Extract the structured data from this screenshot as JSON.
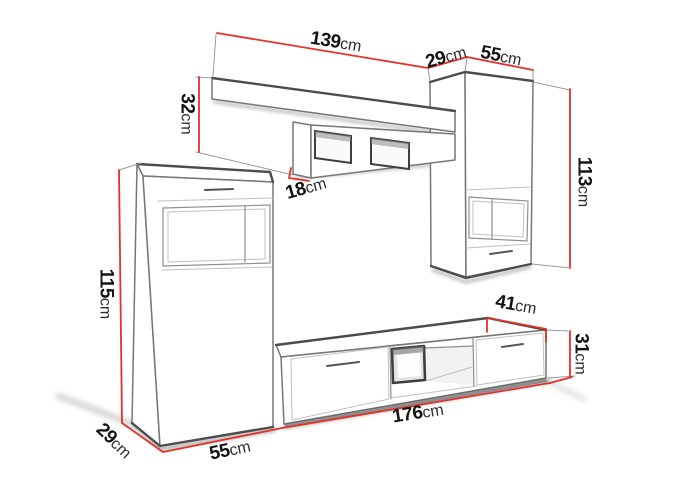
{
  "colors": {
    "background": "#ffffff",
    "dimension_line": "#e23229",
    "sketch_line": "#767676",
    "label_number": "#141414",
    "label_unit": "#2e2e2e"
  },
  "dimensions": {
    "shelf_width": {
      "value": "139",
      "unit": "cm"
    },
    "right_cabinet_depth": {
      "value": "29",
      "unit": "cm"
    },
    "right_cabinet_width": {
      "value": "55",
      "unit": "cm"
    },
    "shelf_height": {
      "value": "32",
      "unit": "cm"
    },
    "shelf_lower_height": {
      "value": "18",
      "unit": "cm"
    },
    "right_cabinet_height": {
      "value": "113",
      "unit": "cm"
    },
    "left_cabinet_height": {
      "value": "115",
      "unit": "cm"
    },
    "left_cabinet_depth": {
      "value": "29",
      "unit": "cm"
    },
    "left_cabinet_width": {
      "value": "55",
      "unit": "cm"
    },
    "tv_stand_width": {
      "value": "176",
      "unit": "cm"
    },
    "tv_stand_depth": {
      "value": "41",
      "unit": "cm"
    },
    "tv_stand_height": {
      "value": "31",
      "unit": "cm"
    }
  }
}
